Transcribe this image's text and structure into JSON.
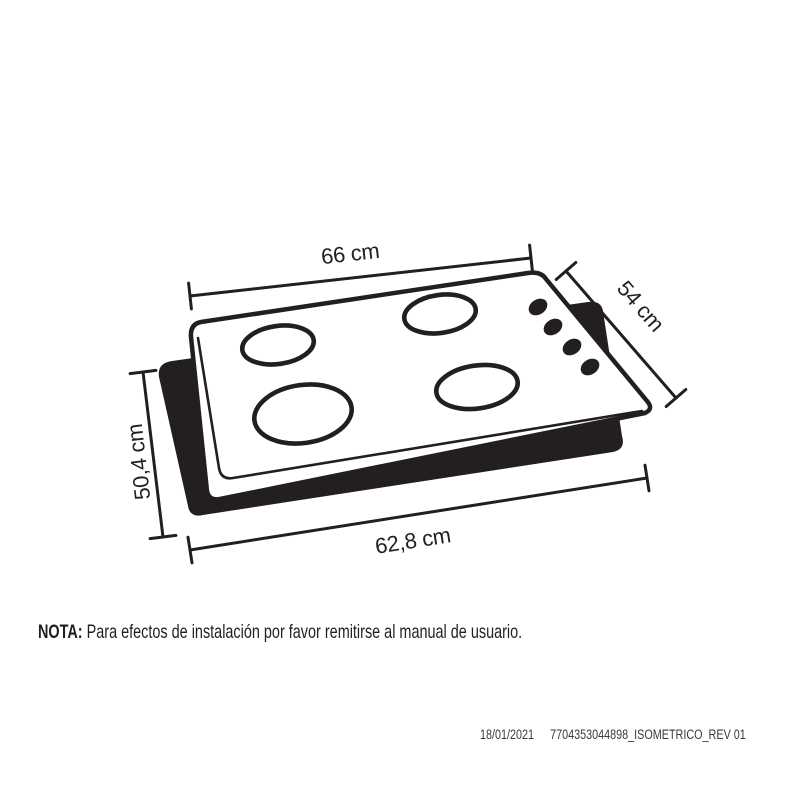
{
  "colors": {
    "ink": "#231f20",
    "background": "#ffffff",
    "footer_text": "#3a3a3a"
  },
  "diagram": {
    "kind": "cooktop isometric dimension drawing",
    "burner_count": 4,
    "knob_count": 4,
    "dimensions": {
      "top_width": "66 cm",
      "right_depth": "54 cm",
      "left_height": "50,4 cm",
      "bottom_width": "62,8 cm"
    }
  },
  "note": {
    "label": "NOTA:",
    "text": "Para efectos de instalación por favor remitirse al manual de usuario."
  },
  "footer": {
    "date": "18/01/2021",
    "reference": "7704353044898_ISOMETRICO_REV 01"
  }
}
